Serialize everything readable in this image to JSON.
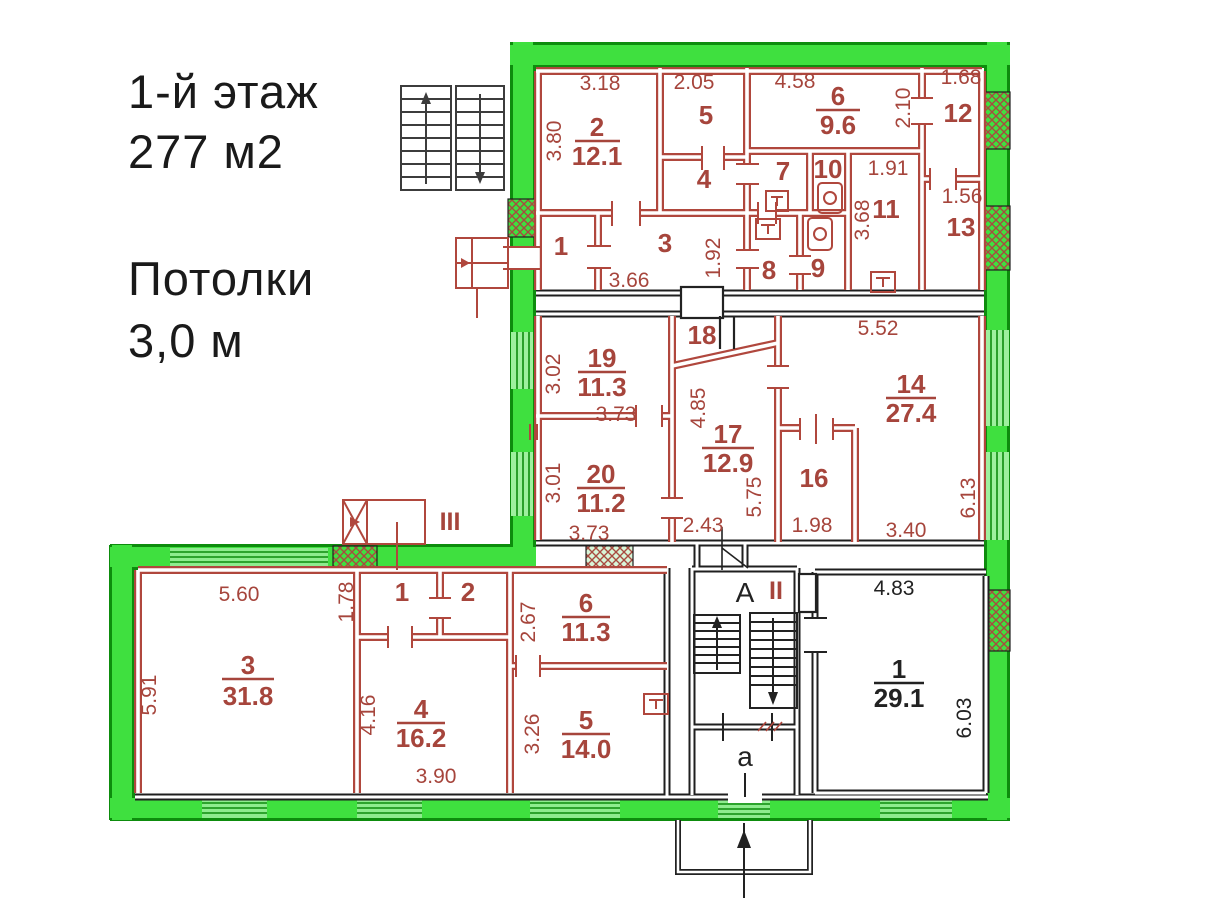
{
  "header": {
    "floor": "1-й этаж",
    "total_area": "277 м2",
    "ceilings_label": "Потолки",
    "ceilings_value": "3,0 м"
  },
  "colors": {
    "highlight_green": "#3fe03f",
    "green_edge": "#0d8c0d",
    "wall_red": "#b0473d",
    "text_red": "#a6453c",
    "wall_black": "#1f1f1f"
  },
  "plan": {
    "top": {
      "dims": {
        "w2": "3.18",
        "h2": "3.80",
        "w5": "2.05",
        "w6": "4.58",
        "h12": "2.10",
        "w12": "1.68",
        "w11": "1.91",
        "h11": "3.68",
        "w13": "1.56",
        "w3": "3.66",
        "h3": "1.92"
      },
      "rooms": {
        "n2": "2",
        "a2": "12.1",
        "n5": "5",
        "n4": "4",
        "n6": "6",
        "a6": "9.6",
        "n12": "12",
        "n7": "7",
        "n10": "10",
        "n11": "11",
        "n13": "13",
        "n1": "1",
        "n3": "3",
        "n8": "8",
        "n9": "9"
      }
    },
    "middle": {
      "dims": {
        "w14t": "5.52",
        "h19": "3.02",
        "w19": "3.73",
        "h17a": "4.85",
        "h20": "3.01",
        "w20": "3.73",
        "h17b": "5.75",
        "h14": "6.13",
        "w17": "2.43",
        "w16": "1.98",
        "w14b": "3.40"
      },
      "rooms": {
        "n18": "18",
        "n19": "19",
        "a19": "11.3",
        "n14": "14",
        "a14": "27.4",
        "n17": "17",
        "a17": "12.9",
        "n20": "20",
        "a20": "11.2",
        "n16": "16"
      }
    },
    "bottom": {
      "dims": {
        "w3": "5.60",
        "h1s": "1.78",
        "h6": "2.67",
        "w1": "4.83",
        "h3": "5.91",
        "h4": "4.16",
        "h5": "3.26",
        "h1": "6.03",
        "w4": "3.90"
      },
      "rooms": {
        "n3": "3",
        "a3": "31.8",
        "n1s": "1",
        "n2s": "2",
        "n6": "6",
        "a6": "11.3",
        "n4": "4",
        "a4": "16.2",
        "n5": "5",
        "a5": "14.0",
        "n1": "1",
        "a1": "29.1"
      },
      "marks": {
        "stair": "А",
        "roman2": "II",
        "roman3": "III",
        "exit": "а"
      }
    }
  }
}
